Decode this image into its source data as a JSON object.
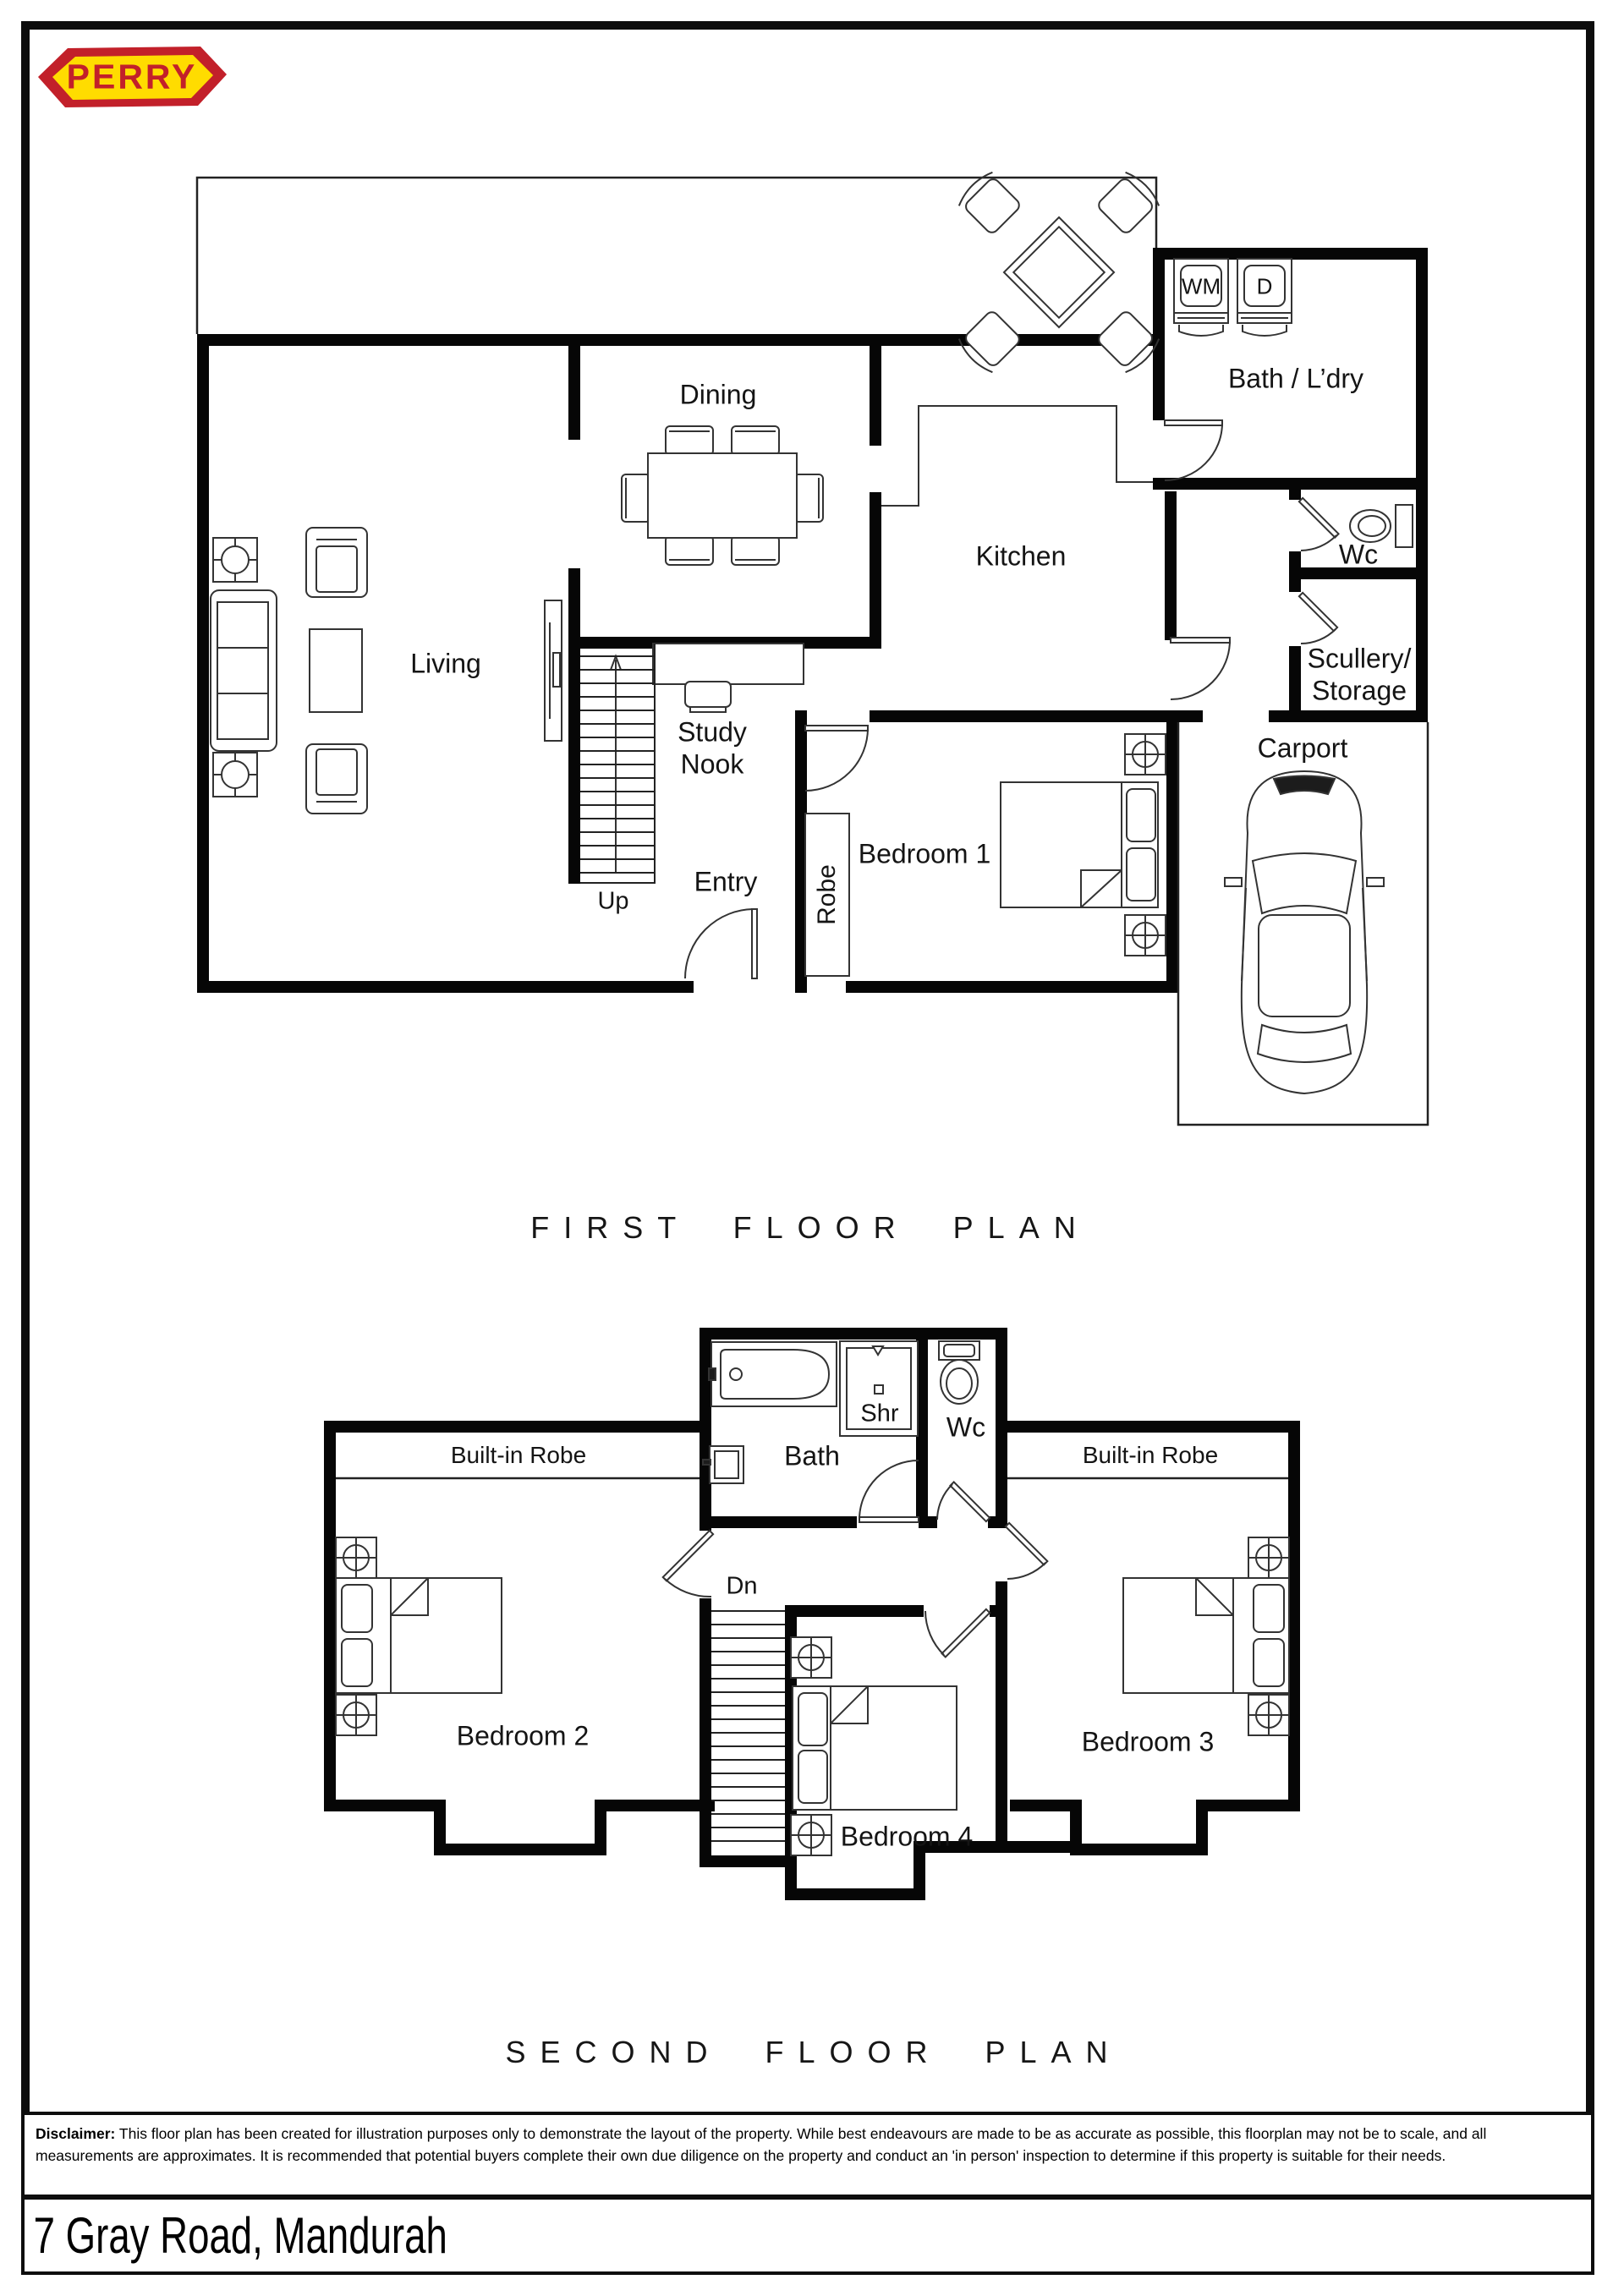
{
  "logo": {
    "text": "PERRY"
  },
  "first_floor": {
    "title": "FIRST FLOOR PLAN",
    "labels": {
      "dining": "Dining",
      "kitchen": "Kitchen",
      "bath_ldry": "Bath / L’dry",
      "wc": "Wc",
      "scullery_line1": "Scullery/",
      "scullery_line2": "Storage",
      "living": "Living",
      "study_line1": "Study",
      "study_line2": "Nook",
      "entry": "Entry",
      "up": "Up",
      "robe": "Robe",
      "bedroom1": "Bedroom 1",
      "carport": "Carport",
      "wm": "WM",
      "dryer": "D"
    }
  },
  "second_floor": {
    "title": "SECOND FLOOR PLAN",
    "labels": {
      "bath": "Bath",
      "shr": "Shr",
      "wc": "Wc",
      "robe_left": "Built-in Robe",
      "robe_right": "Built-in Robe",
      "dn": "Dn",
      "bedroom2": "Bedroom 2",
      "bedroom3": "Bedroom 3",
      "bedroom4": "Bedroom 4"
    }
  },
  "footer": {
    "disclaimer_label": "Disclaimer:",
    "disclaimer_text": " This floor plan has been created for illustration purposes only to demonstrate the layout of the property. While best endeavours are made to be as accurate as possible, this floorplan may not be to scale, and all measurements are approximates. It is recommended that potential buyers complete their own due diligence on the property and conduct an 'in person' inspection to determine if this property is suitable for their needs.",
    "address": "7 Gray Road, Mandurah"
  },
  "colors": {
    "logo_red": "#c2202a",
    "logo_yellow": "#ffdc00",
    "line": "#111111"
  }
}
